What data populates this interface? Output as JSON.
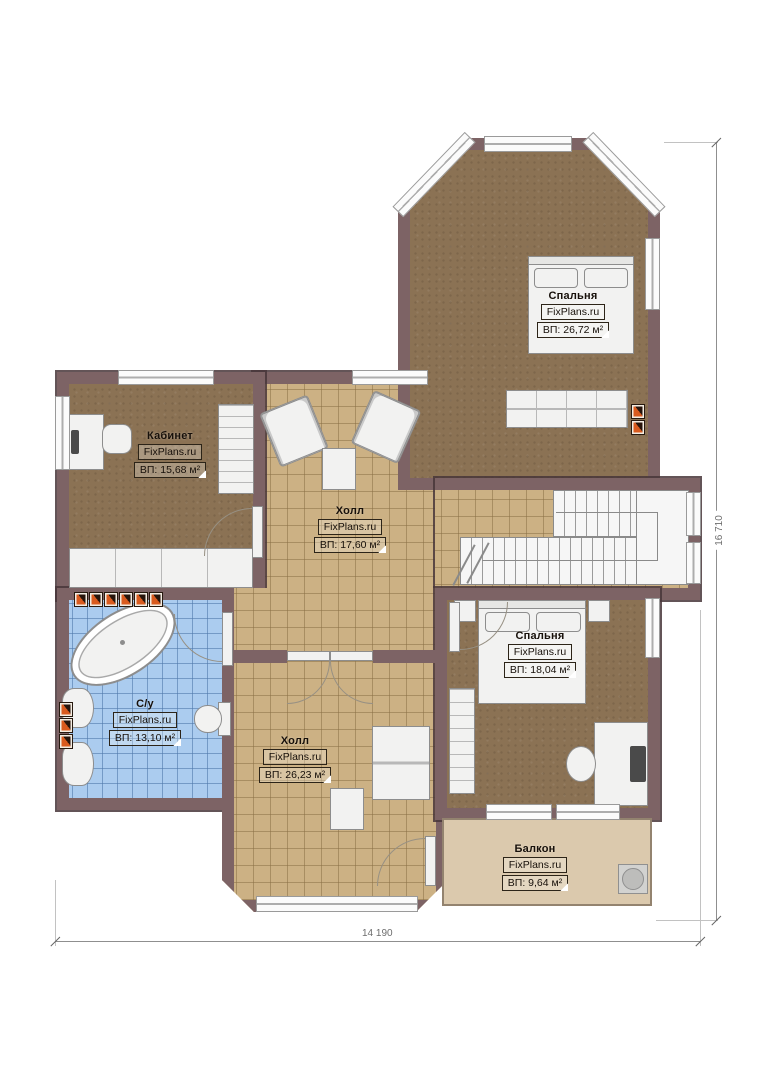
{
  "plan": {
    "site": "FixPlans.ru",
    "rooms": [
      {
        "id": "bedroom-top",
        "name": "Спальня",
        "area": "ВП: 26,72 м²"
      },
      {
        "id": "office",
        "name": "Кабинет",
        "area": "ВП: 15,68 м²"
      },
      {
        "id": "hall-upper",
        "name": "Холл",
        "area": "ВП: 17,60 м²"
      },
      {
        "id": "bathroom",
        "name": "С/у",
        "area": "ВП: 13,10 м²"
      },
      {
        "id": "hall-lower",
        "name": "Холл",
        "area": "ВП: 26,23 м²"
      },
      {
        "id": "bedroom-lower",
        "name": "Спальня",
        "area": "ВП: 18,04 м²"
      },
      {
        "id": "balcony",
        "name": "Балкон",
        "area": "ВП: 9,64 м²"
      }
    ],
    "dimensions": {
      "width_label": "14 190",
      "height_label": "16 710"
    },
    "colors": {
      "wall": "#7d6365",
      "carpet": "#8b7254",
      "hall_tile": "#ccb184",
      "bath_tile": "#abccef",
      "balcony_floor": "#dbc9ad",
      "radiator_accent": "#d95b1f"
    }
  }
}
